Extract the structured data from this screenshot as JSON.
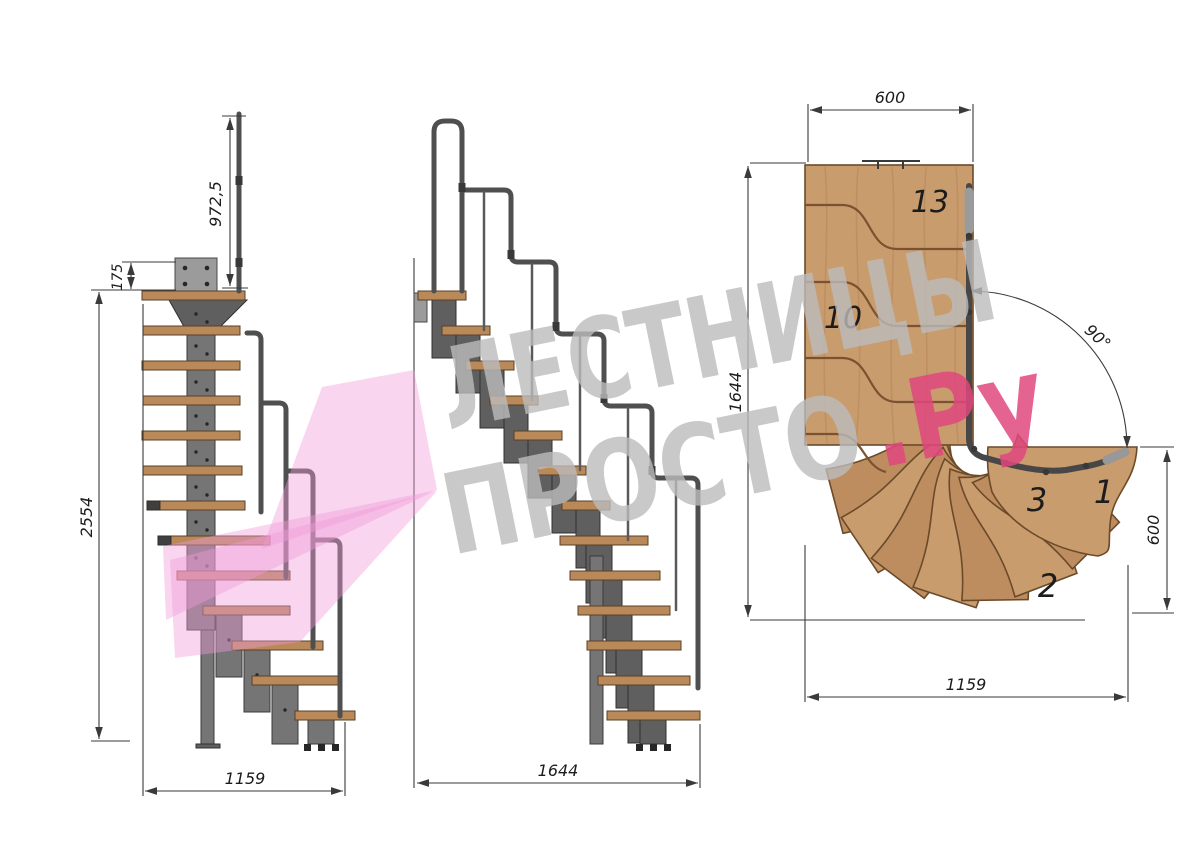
{
  "side_view": {
    "dim_handrail_height": "972,5",
    "dim_plate_height": "175",
    "dim_total_height": "2554",
    "dim_total_run": "1159"
  },
  "front_view": {
    "dim_total_run": "1644"
  },
  "plan_view": {
    "dim_entry_width": "600",
    "dim_total_depth": "1644",
    "dim_turn_angle": "90°",
    "dim_exit_width": "600",
    "dim_total_run": "1159",
    "steps": {
      "s13": "13",
      "s10": "10",
      "s3": "3",
      "s2": "2",
      "s1": "1"
    }
  },
  "watermark": {
    "brand_line1": "ЛЕСТНИЦЫ",
    "brand_line2": "ПРОСТО",
    "brand_suffix": ".Ру"
  },
  "colors": {
    "wood_side": "#b9895a",
    "wood_plan": "#c99c6e",
    "wood_plan_dark": "#bd8d60",
    "metal": "#757575",
    "metal_dark": "#5f5f5f",
    "rail": "#4f4f4f",
    "dim": "#3a3a3a",
    "label": "#1c1c1c",
    "wm_gray": "#bcbcbc",
    "wm_pink": "#e0487e",
    "arrow_pink": "#f19cd8"
  }
}
